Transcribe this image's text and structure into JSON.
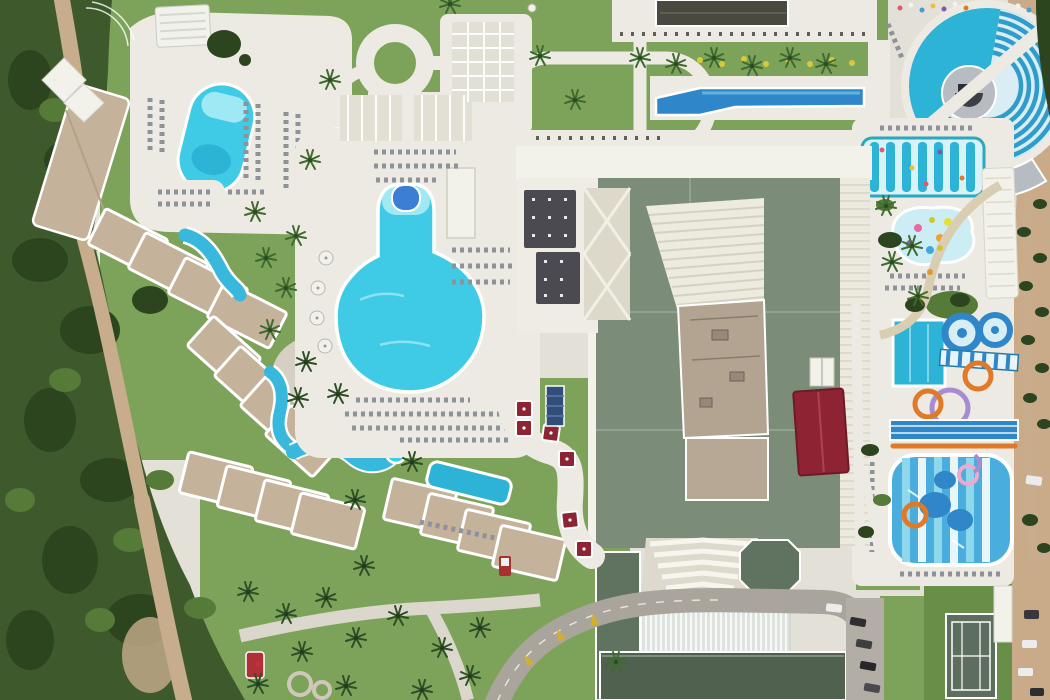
{
  "meta": {
    "type": "aerial-photograph",
    "subject": "top-down drone view of a seaside resort: hotel blocks, lagoon pool, amphitheater pool, aquapark slides, tennis court, gardens and roads",
    "orientation": "top-down"
  },
  "palette": {
    "base": "#e3e0d7",
    "deck": "#eceae2",
    "deck2": "#e2dfd4",
    "white": "#f2f1ea",
    "lawn": "#7da35a",
    "lawn2": "#688f48",
    "wild": "#3e5a2d",
    "wild2": "#2c451f",
    "scrub": "#567a38",
    "sand": "#c8ad8c",
    "dirt": "#c9ab89",
    "pool": "#3fcbe6",
    "pool2": "#2cb3d6",
    "pool3": "#a8ecf4",
    "navy": "#3a7fd4",
    "lane": "#2f86c8",
    "slide": "#38b8dc",
    "arcstroke": "#2f9cc9",
    "tan": "#c4b29a",
    "tan2": "#b3a492",
    "groof": "#7b8c79",
    "groof2": "#5f7360",
    "groof3": "#50614f",
    "wroof": "#eeece4",
    "droof": "#4a4a50",
    "thatch": "#49493f",
    "red": "#8e2433",
    "orange": "#e07a28",
    "purple": "#a88cd0",
    "pink": "#f0a8cc",
    "yellow": "#d4c430",
    "asphalt": "#a9a59c",
    "court": "#5e6e5e",
    "gray": "#b6bcc2",
    "chair": "#8e929a"
  },
  "areas": [
    {
      "id": "left-wild-vegetation",
      "label": "wild scrub and sand strip"
    },
    {
      "id": "upper-left-pool",
      "label": "oval relax pool with sun loungers"
    },
    {
      "id": "lagoon-pool",
      "label": "large free-form main pool"
    },
    {
      "id": "zigzag-hotel-blocks",
      "label": "terraced hotel wings with snaking pools"
    },
    {
      "id": "main-hotel-building",
      "label": "central hotel complex roofs"
    },
    {
      "id": "amphitheater-pool",
      "label": "circular pool with amphitheater steps"
    },
    {
      "id": "kids-splash-zone",
      "label": "children splash lanes and kiddie pool"
    },
    {
      "id": "waterslide-towers",
      "label": "slide towers, racer lanes and rings"
    },
    {
      "id": "aqua-playground",
      "label": "striped aqua playground pool"
    },
    {
      "id": "tennis-court",
      "label": "tennis court"
    },
    {
      "id": "access-road",
      "label": "service road with lane arrows"
    },
    {
      "id": "right-dirt-strip",
      "label": "dirt orchard strip with parked cars"
    }
  ]
}
